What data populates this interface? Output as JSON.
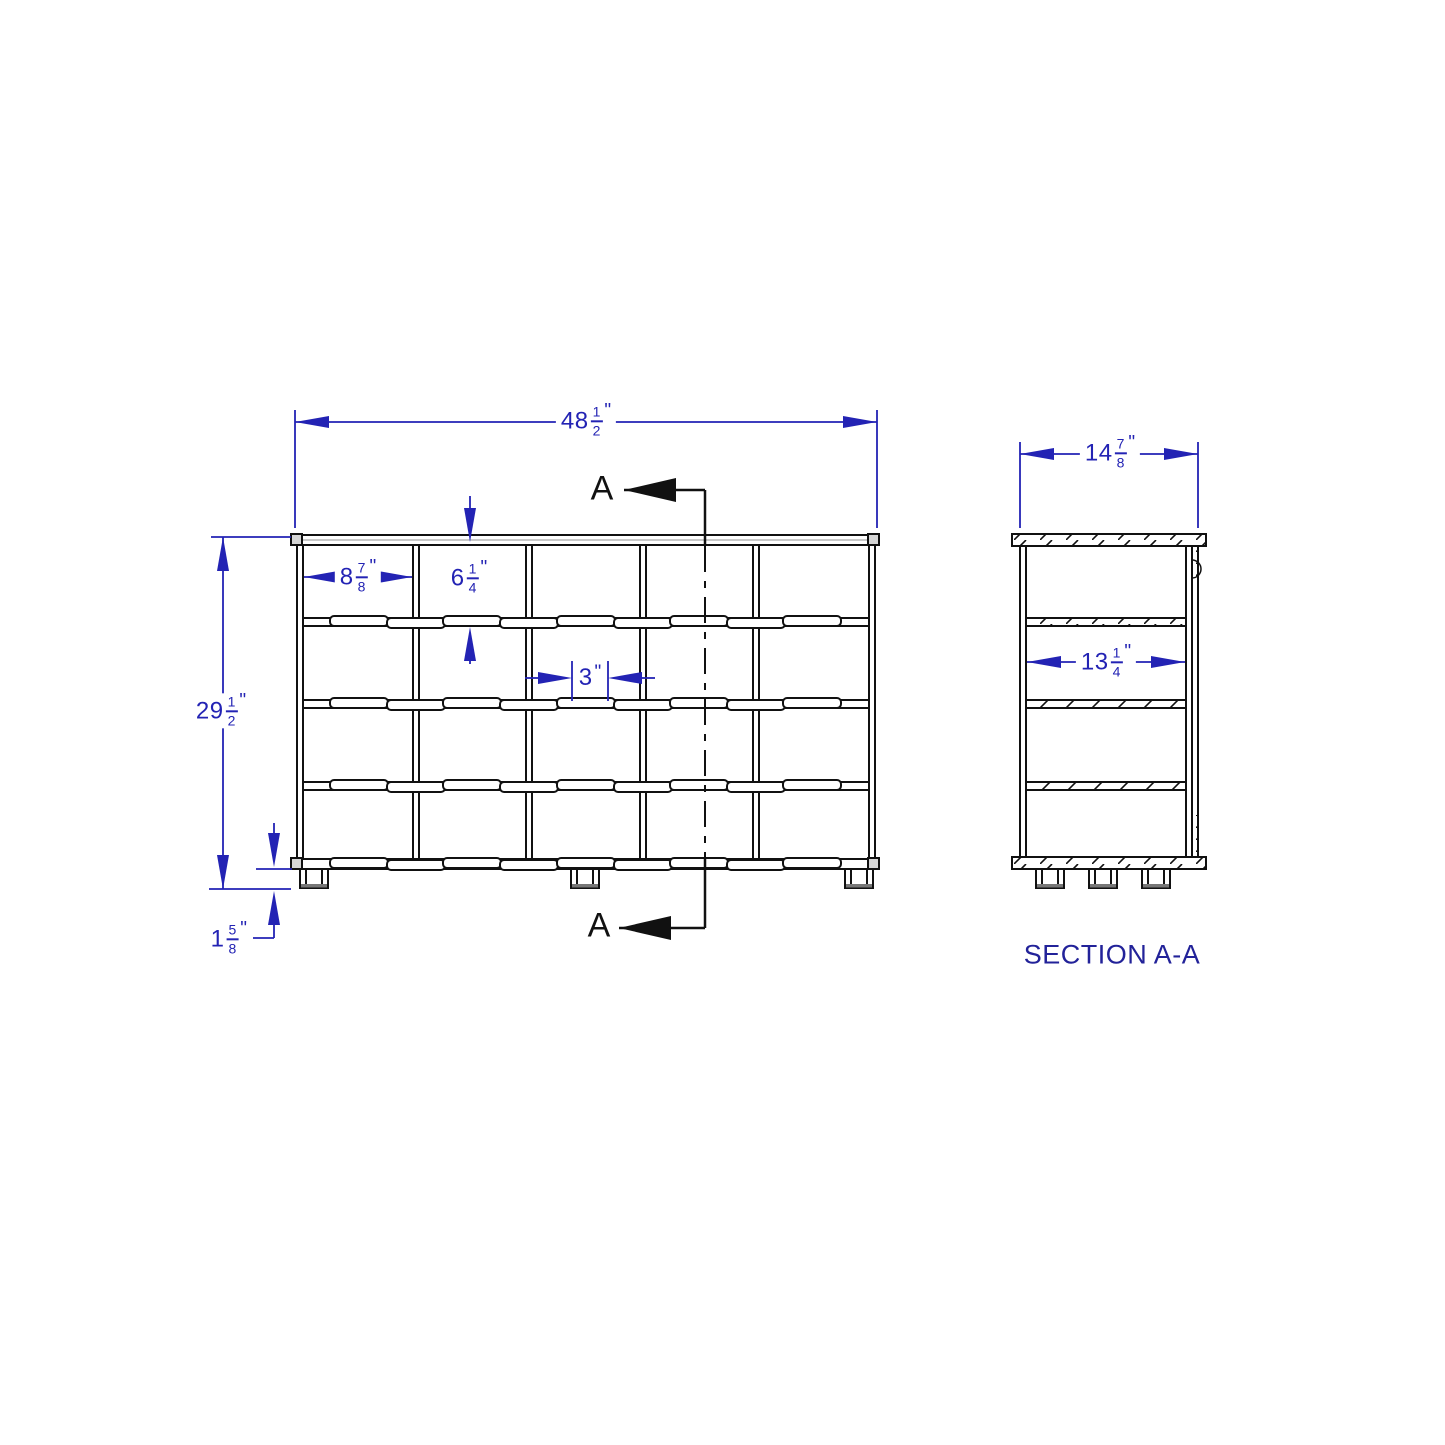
{
  "front_view": {
    "dim_overall_width": {
      "whole": "48",
      "num": "1",
      "den": "2",
      "unit": "\""
    },
    "dim_overall_height": {
      "whole": "29",
      "num": "1",
      "den": "2",
      "unit": "\""
    },
    "dim_cubby_width": {
      "whole": "8",
      "num": "7",
      "den": "8",
      "unit": "\""
    },
    "dim_cubby_height": {
      "whole": "6",
      "num": "1",
      "den": "4",
      "unit": "\""
    },
    "dim_spacing": {
      "whole": "3",
      "unit": "\""
    },
    "dim_leg_height": {
      "whole": "1",
      "num": "5",
      "den": "8",
      "unit": "\""
    }
  },
  "section_view": {
    "dim_depth": {
      "whole": "14",
      "num": "7",
      "den": "8",
      "unit": "\""
    },
    "dim_inner_width": {
      "whole": "13",
      "num": "1",
      "den": "4",
      "unit": "\""
    },
    "label": "SECTION A-A"
  },
  "markers": {
    "top": "A",
    "bottom": "A"
  },
  "colors": {
    "dimension_blue": "#2323B4",
    "section_label_blue": "#222299",
    "drawing_black": "#111111"
  }
}
